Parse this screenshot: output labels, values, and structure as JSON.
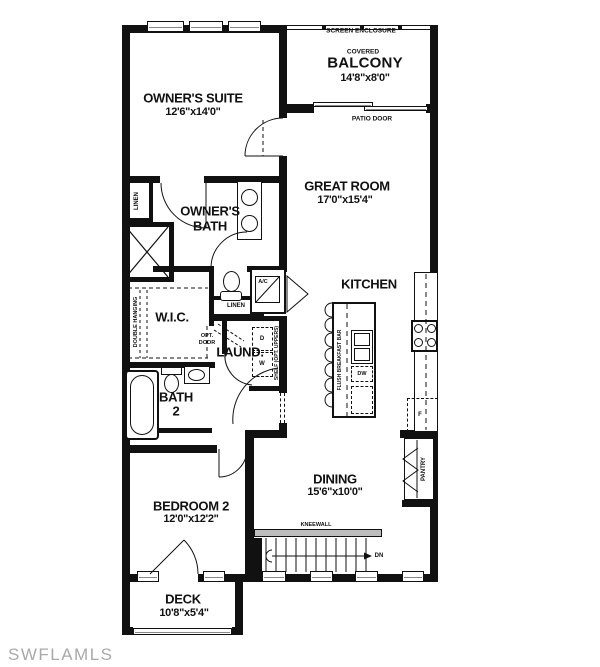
{
  "colors": {
    "ink": "#111111",
    "watermark_gray": "#a9a9a9",
    "background": "#ffffff"
  },
  "watermark": {
    "text": "SWFLAMLS"
  },
  "rooms": {
    "owners_suite": {
      "name": "OWNER'S SUITE",
      "dims": "12'6\"x14'0\""
    },
    "balcony": {
      "covered": "COVERED",
      "name": "BALCONY",
      "dims": "14'8\"x8'0\""
    },
    "great_room": {
      "name": "GREAT ROOM",
      "dims": "17'0\"x15'4\""
    },
    "owners_bath": {
      "line1": "OWNER'S",
      "line2": "BATH"
    },
    "wic": {
      "name": "W.I.C."
    },
    "laundry": {
      "name": "LAUND."
    },
    "bath2": {
      "line1": "BATH",
      "line2": "2"
    },
    "kitchen": {
      "name": "KITCHEN"
    },
    "dining": {
      "name": "DINING",
      "dims": "15'6\"x10'0\""
    },
    "bedroom2": {
      "name": "BEDROOM 2",
      "dims": "12'0\"x12'2\""
    },
    "deck": {
      "name": "DECK",
      "dims": "10'8\"x5'4\""
    }
  },
  "labels": {
    "screen_enclosure": "SCREEN ENCLOSURE",
    "patio_door": "PATIO DOOR",
    "linen1": "LINEN",
    "linen2": "LINEN",
    "double_hanging": "DOUBLE HANGING",
    "opt_door_line1": "OPT.",
    "opt_door_line2": "DOOR",
    "ac": "A/C",
    "dryer": "D",
    "washer": "W",
    "shelf": "SHELF (OPT. UPPERS)",
    "flush_bar": "FLUSH BREAKFAST BAR",
    "dw": "DW",
    "fridge": "F",
    "pantry": "PANTRY",
    "kneewall": "KNEEWALL",
    "dn": "DN"
  }
}
